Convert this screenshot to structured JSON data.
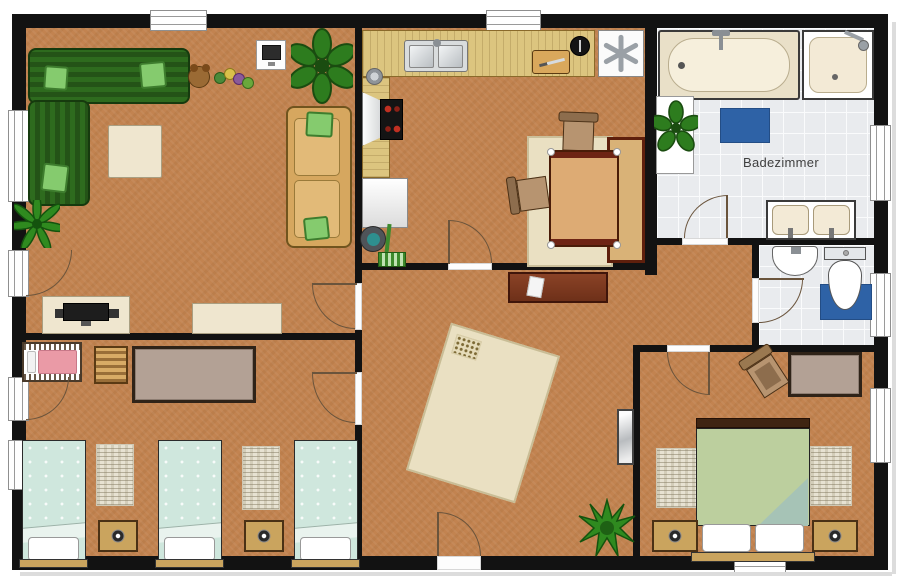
{
  "plan_title": "apartment-floor-plan",
  "rooms": {
    "living_room": {
      "furniture": [
        "corner-sofa",
        "coffee-table",
        "toys",
        "wall-monitor",
        "large-potted-plant",
        "two-seat-sofa",
        "palm-plant",
        "tv-console",
        "tv",
        "bench"
      ]
    },
    "kitchen_dining": {
      "furniture": [
        "kitchen-counter",
        "double-sink",
        "stove-with-hood",
        "pot",
        "cutting-board",
        "freezer",
        "washing-machine",
        "bucket",
        "mop",
        "dining-table",
        "dining-chair",
        "dining-chair",
        "dining-rug",
        "dining-bench"
      ]
    },
    "bathroom": {
      "label": "Badezimmer",
      "furniture": [
        "bathtub",
        "shower",
        "double-vanity",
        "bath-mat",
        "plant-stand",
        "potted-plant"
      ]
    },
    "wc": {
      "furniture": [
        "wash-basin",
        "toilet",
        "toilet-mat"
      ]
    },
    "hall": {
      "furniture": [
        "sideboard",
        "paper-sheet",
        "patterned-rug",
        "mirror",
        "spiky-plant",
        "entrance-door"
      ]
    },
    "kids_bedroom": {
      "furniture": [
        "crib",
        "striped-dresser",
        "large-rug",
        "single-bed",
        "single-bed",
        "single-bed",
        "bedside-rug",
        "bedside-rug",
        "nightstand",
        "nightstand"
      ]
    },
    "bedroom": {
      "furniture": [
        "double-bed",
        "nightstand",
        "nightstand",
        "bedside-rug",
        "bedside-rug",
        "chair",
        "rug"
      ]
    }
  },
  "palette": {
    "floor": "#c28350",
    "wall": "#121212",
    "tile": "#e9ebee",
    "wood": "#dcc57f",
    "cream": "#efe6cf",
    "sofa_green": "#2e6b1e",
    "cushion_green": "#85cb6e",
    "tan_sofa": "#d6a75f",
    "mat_blue": "#2e62a6",
    "mint": "#cfe7dd",
    "bed_green": "#bccf9e",
    "mauve": "#b3a195",
    "maroon": "#6e2414",
    "pink": "#ea9aa6",
    "rug_cream": "#eae0c2",
    "nightstand": "#caa45e"
  }
}
